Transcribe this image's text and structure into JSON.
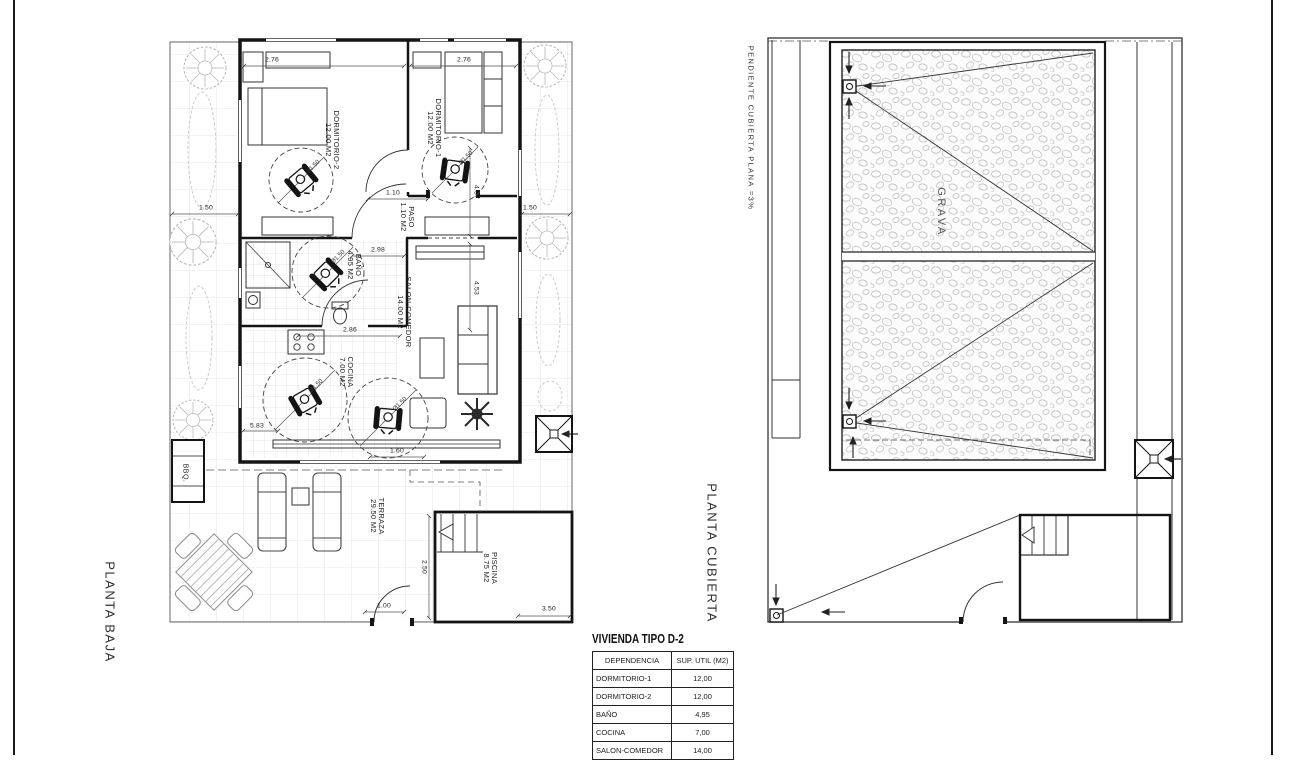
{
  "ground_floor": {
    "title": "PLANTA BAJA",
    "bbq_label": "BBQ.",
    "rooms": [
      {
        "name": "DORMITORIO-2",
        "area": "12.00 M2"
      },
      {
        "name": "DORMITORIO-1",
        "area": "12.00 M2"
      },
      {
        "name": "PASO",
        "area": "1.10 M2"
      },
      {
        "name": "BAÑO",
        "area": "4.95 M2"
      },
      {
        "name": "SALON-COMEDOR",
        "area": "14.00 M2"
      },
      {
        "name": "COCINA",
        "area": "7.00 M2"
      },
      {
        "name": "TERRAZA",
        "area": "29.50 M2"
      },
      {
        "name": "PISCINA",
        "area": "8.75 M2"
      }
    ],
    "dimensions": [
      "2.76",
      "2.76",
      "1.50",
      "1.50",
      "1.10",
      "4.37",
      "2.98",
      "4.53",
      "2.86",
      "5.83",
      "1.60",
      "1.00",
      "2.50",
      "3.50"
    ],
    "wheelchair_dims": [
      "Ø1.50",
      "Ø1.50",
      "Ø1.50",
      "Ø1.50",
      "Ø1.50"
    ]
  },
  "roof_plan": {
    "title": "PLANTA CUBIERTA",
    "slope_note": "PENDIENTE CUBIERTA PLANA =3%",
    "material_label": "GRAVA"
  },
  "summary_table": {
    "title": "VIVIENDA TIPO D-2",
    "columns": [
      "DEPENDENCIA",
      "SUP. UTIL (M2)"
    ],
    "rows": [
      {
        "room": "DORMITORIO-1",
        "area": "12,00"
      },
      {
        "room": "DORMITORIO-2",
        "area": "12,00"
      },
      {
        "room": "BAÑO",
        "area": "4,95"
      },
      {
        "room": "COCINA",
        "area": "7,00"
      },
      {
        "room": "SALON-COMEDOR",
        "area": "14,00"
      }
    ]
  }
}
